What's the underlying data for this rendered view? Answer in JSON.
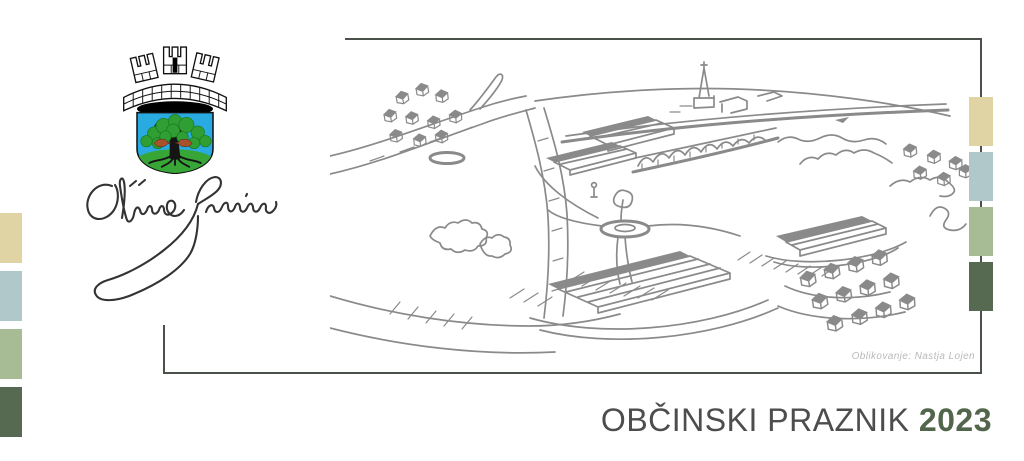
{
  "title": {
    "text": "OBČINSKI PRAZNIK",
    "year": "2023"
  },
  "credit": "Oblikovanje: Nastja Lojen",
  "logo": {
    "emblem": "sevnica-coat-of-arms",
    "signature": "Občina Sevnica"
  },
  "sketch": {
    "name": "sevnica-town-sketch"
  },
  "palette": {
    "square_colors": [
      "#e0d4a4",
      "#b1c8cb",
      "#a7bc95",
      "#556a50"
    ],
    "title_color": "#4d4d4d",
    "year_color": "#52664c",
    "frame_color": "#4a504a",
    "sketch_color": "#8a8a8a",
    "credit_color": "#b9b9b9",
    "shield_blue": "#29abe2",
    "tree_green": "#2f9e33",
    "ground_green": "#38a637",
    "bird_brown": "#a8512b"
  }
}
